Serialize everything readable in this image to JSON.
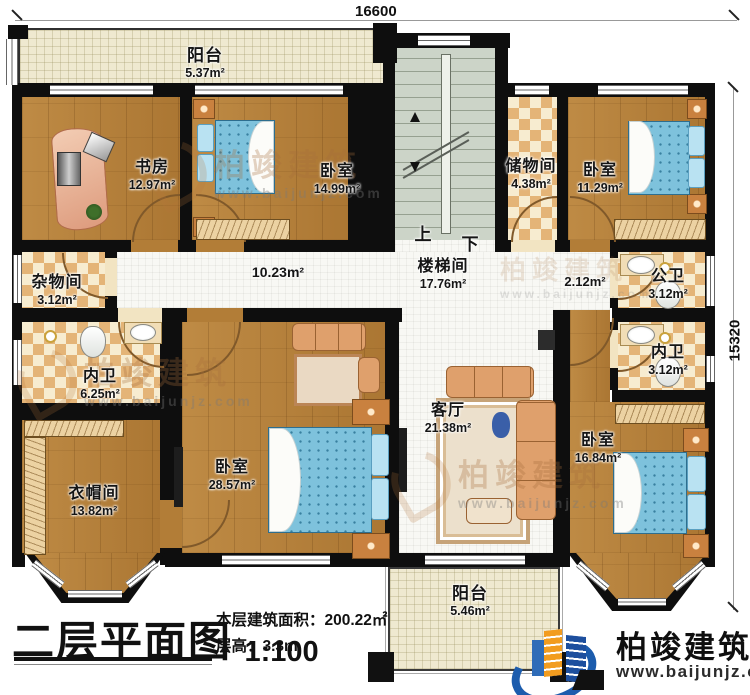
{
  "dimensions": {
    "top": "16600",
    "right": "15320"
  },
  "stairwell": {
    "up": "上",
    "down": "下"
  },
  "rooms": {
    "balcony_top": {
      "name": "阳台",
      "area": "5.37m²"
    },
    "study": {
      "name": "书房",
      "area": "12.97m²"
    },
    "bedroom_nw": {
      "name": "卧室",
      "area": "14.99m²"
    },
    "staircase": {
      "name": "楼梯间",
      "area": "17.76m²"
    },
    "storage": {
      "name": "储物间",
      "area": "4.38m²"
    },
    "bedroom_ne": {
      "name": "卧室",
      "area": "11.29m²"
    },
    "utility": {
      "name": "杂物间",
      "area": "3.12m²"
    },
    "hallway": {
      "area": "10.23m²"
    },
    "hallway_east": {
      "area": "2.12m²"
    },
    "bath_public": {
      "name": "公卫",
      "area": "3.12m²"
    },
    "bath_inner_east": {
      "name": "内卫",
      "area": "3.12m²"
    },
    "bath_inner_west": {
      "name": "内卫",
      "area": "6.25m²"
    },
    "cloakroom": {
      "name": "衣帽间",
      "area": "13.82m²"
    },
    "bedroom_master": {
      "name": "卧室",
      "area": "28.57m²"
    },
    "living": {
      "name": "客厅",
      "area": "21.38m²"
    },
    "bedroom_se": {
      "name": "卧室",
      "area": "16.84m²"
    },
    "balcony_bottom": {
      "name": "阳台",
      "area": "5.46m²"
    }
  },
  "title_block": {
    "title": "二层平面图",
    "scale": "1:100",
    "floor_area": "本层建筑面积：200.22㎡",
    "floor_height": "层高：3.3m"
  },
  "branding": {
    "company": "柏竣建筑",
    "website": "www.baijunjz.com"
  },
  "colors": {
    "wall": "#0e0e0e",
    "wood": "#b27d37",
    "checker_light": "#f7ecd0",
    "checker_dark": "#e4b477",
    "stair": "#ccd4c8",
    "balcony": "#efe9d0",
    "corridor": "#f8f8f4",
    "bed": "#7ec2dc",
    "accent_blue": "#1c5cad",
    "accent_orange": "#f29c1f"
  }
}
